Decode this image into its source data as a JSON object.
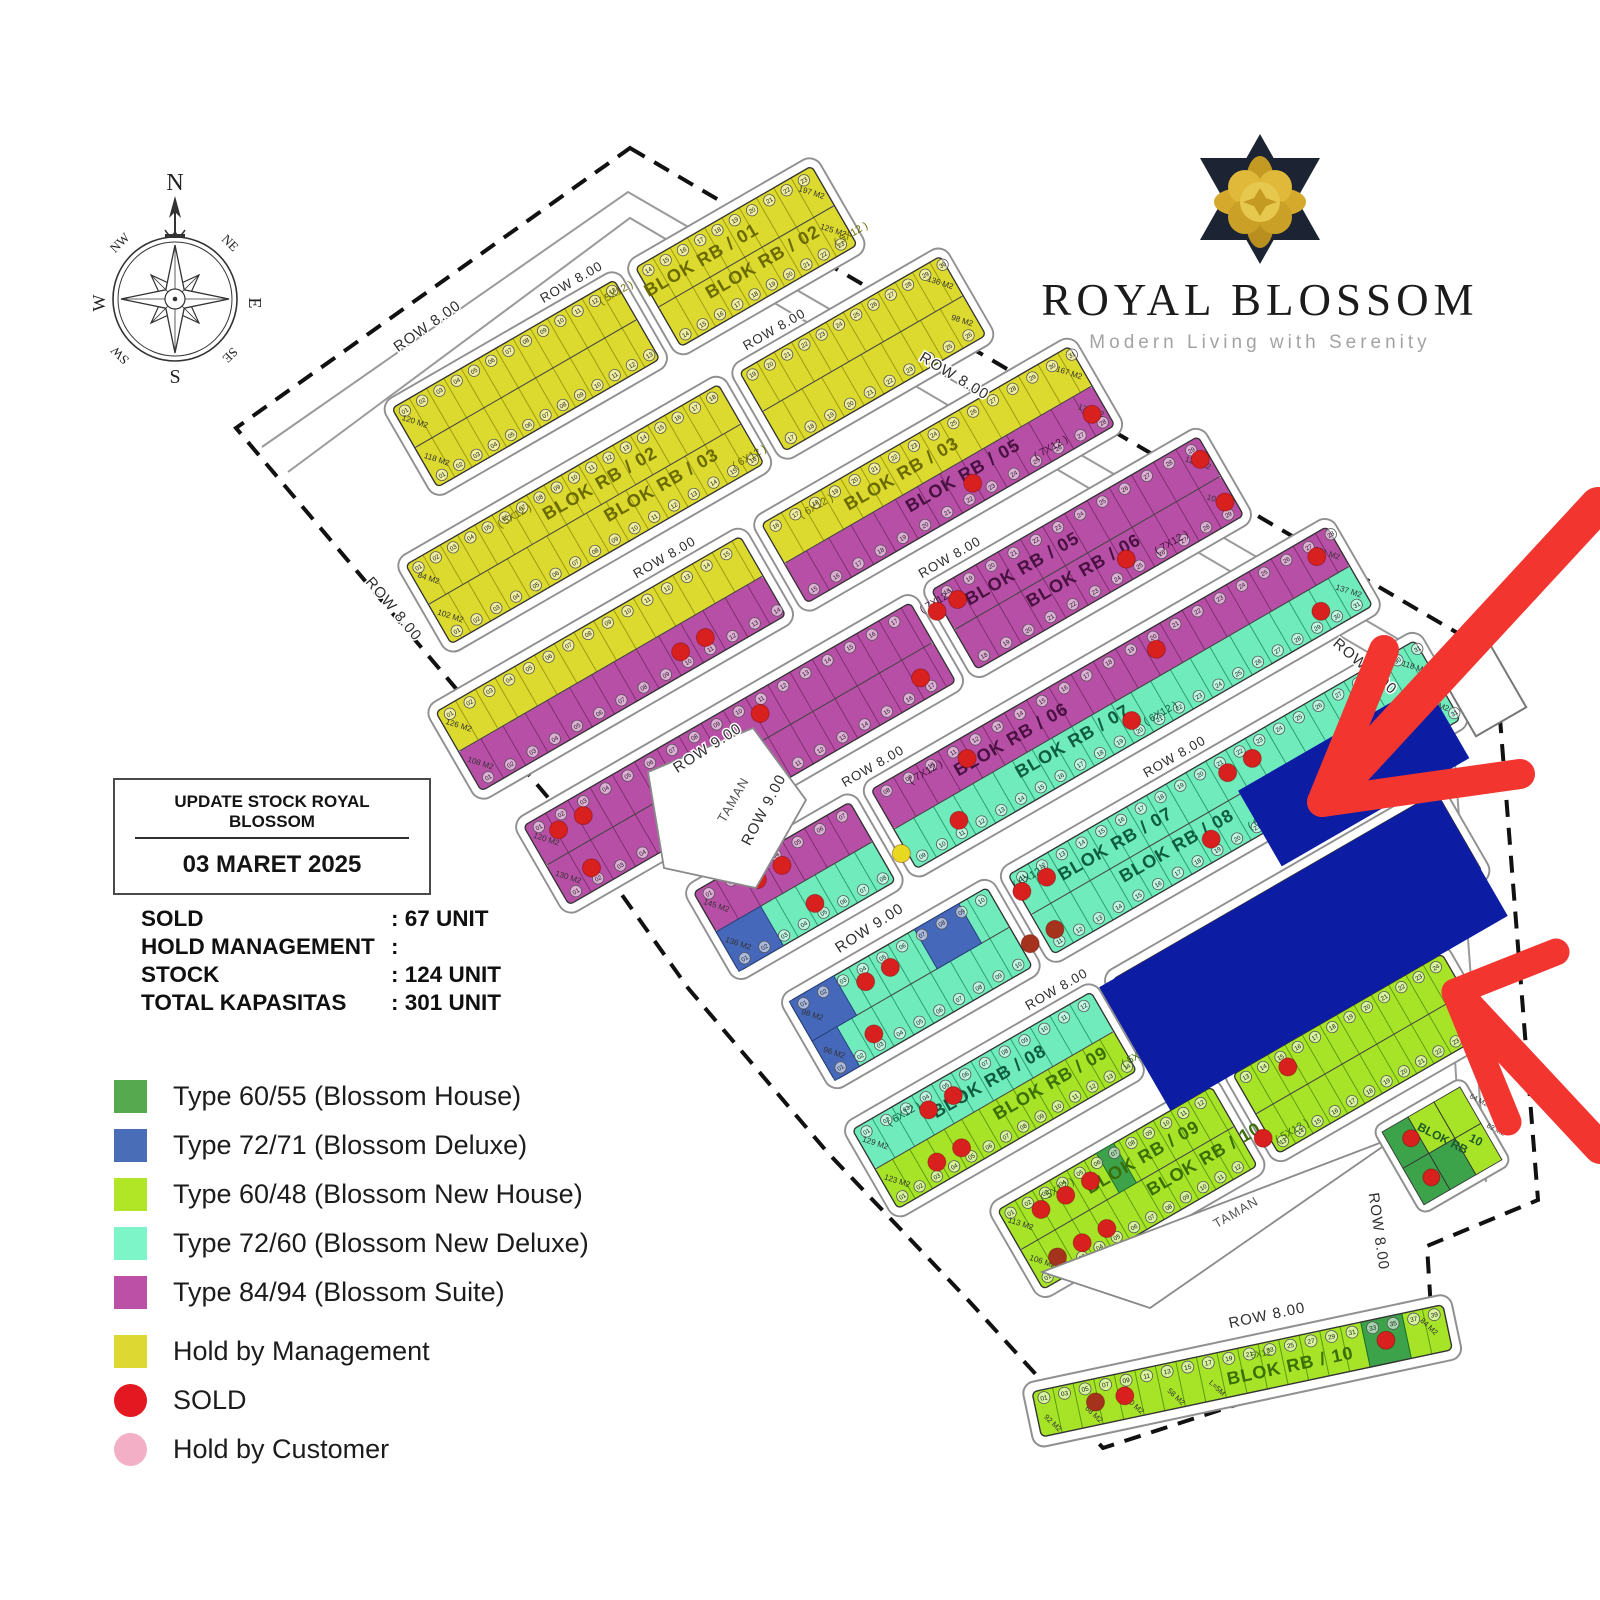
{
  "logo": {
    "title": "ROYAL BLOSSOM",
    "tagline": "Modern Living with Serenity",
    "flower_gold": "#d4a92c",
    "flower_dark": "#1c2433"
  },
  "compass": {
    "points": [
      "N",
      "NE",
      "E",
      "SE",
      "S",
      "SW",
      "W",
      "NW"
    ]
  },
  "stock_box": {
    "title": "UPDATE STOCK ROYAL BLOSSOM",
    "date": "03 MARET 2025"
  },
  "stats": [
    {
      "label": "SOLD",
      "value": ": 67 UNIT"
    },
    {
      "label": "HOLD MANAGEMENT",
      "value": ":"
    },
    {
      "label": "STOCK",
      "value": ": 124 UNIT"
    },
    {
      "label": "TOTAL KAPASITAS",
      "value": ": 301 UNIT"
    }
  ],
  "legend": [
    {
      "shape": "square",
      "color": "#56a94e",
      "label": "Type 60/55 (Blossom House)"
    },
    {
      "shape": "square",
      "color": "#4a6db8",
      "label": "Type 72/71 (Blossom Deluxe)"
    },
    {
      "shape": "square",
      "color": "#b0e626",
      "label": "Type 60/48 (Blossom New House)"
    },
    {
      "shape": "square",
      "color": "#7df5c9",
      "label": "Type 72/60 (Blossom New Deluxe)"
    },
    {
      "shape": "square",
      "color": "#bb50a6",
      "label": "Type 84/94 (Blossom Suite)"
    },
    {
      "shape": "square",
      "color": "#ddd832",
      "label": "Hold by Management",
      "gap": true
    },
    {
      "shape": "circle",
      "color": "#e31820",
      "label": "SOLD"
    },
    {
      "shape": "circle",
      "color": "#f2afc6",
      "label": "Hold by Customer"
    }
  ],
  "plan": {
    "angle": -30,
    "origin": [
      285,
      470
    ],
    "scale": 0.95,
    "pitch": 150,
    "strip_h": 96,
    "half_h": 48,
    "cross_gap": 26,
    "lot_w": {
      "5": 21,
      "6": 24,
      "7": 27
    },
    "road_label": "ROW 8.00",
    "colors": {
      "yellow": "#dcd92f",
      "purple": "#b84fa6",
      "teal": "#70ecbc",
      "lime": "#a7e428",
      "green": "#3da34b",
      "bluelot": "#4668bb",
      "navy": "#0c1da4",
      "sold": "#d8201f",
      "soldDark": "#a5321c",
      "hold": "#e8d820",
      "road": "#909090"
    },
    "label_fill": {
      "yellow": "#6a6a00",
      "purple": "#471140",
      "teal": "#0f5c40",
      "lime": "#3a6e06"
    },
    "line_fill": {
      "yellow": "#9a9a10",
      "purple": "#7c2e6e",
      "teal": "#2a9a72",
      "lime": "#5d9a12",
      "green": "#1d6e2a",
      "bluelot": "#24407e"
    },
    "boundary": [
      [
        630,
        148
      ],
      [
        1495,
        655
      ],
      [
        1538,
        1200
      ],
      [
        1427,
        1246
      ],
      [
        1433,
        1341
      ],
      [
        1103,
        1448
      ],
      [
        968,
        1300
      ],
      [
        828,
        1153
      ],
      [
        688,
        988
      ],
      [
        578,
        833
      ],
      [
        236,
        428
      ]
    ],
    "road_lines": [
      [
        [
          262,
          447
        ],
        [
          628,
          192
        ],
        [
          1448,
          668
        ],
        [
          1486,
          1182
        ]
      ],
      [
        [
          288,
          472
        ],
        [
          630,
          218
        ],
        [
          1432,
          690
        ],
        [
          1462,
          1172
        ]
      ]
    ],
    "rows": [
      {
        "u0": 130,
        "u1": 640,
        "splits": [
          400
        ],
        "label_u": 490,
        "road_u": 360,
        "top": {
          "name": "BLOK RB / 01",
          "dim": "5X12",
          "color": "yellow"
        },
        "bottom": {
          "name": "BLOK RB / 02",
          "dim": "5X12",
          "color": "yellow"
        },
        "left_labels": [
          "120 M2",
          "118 M2"
        ],
        "right_labels": [
          "197 M2",
          "125 M2"
        ],
        "dots": [],
        "special": []
      },
      {
        "u0": 60,
        "u1": 710,
        "splits": [
          440
        ],
        "label_u": 280,
        "road_u": 520,
        "top": {
          "name": "BLOK RB / 02",
          "dim": "5X12",
          "color": "yellow"
        },
        "bottom": {
          "name": "BLOK RB / 03",
          "dim": "6X12",
          "color": "yellow"
        },
        "left_labels": [
          "84 M2",
          "102 M2"
        ],
        "right_labels": [
          "136 M2",
          "98 M2"
        ],
        "dots": [],
        "special": []
      },
      {
        "u0": 10,
        "u1": 780,
        "splits": [
          380
        ],
        "label_u": 560,
        "road_u": 300,
        "top": {
          "name": "BLOK RB / 03",
          "dim": "6X12",
          "color": "yellow"
        },
        "bottom": {
          "name": "BLOK RB / 05",
          "dim": "7X12",
          "color": "purple"
        },
        "left_labels": [
          "126 M2",
          "108 M2"
        ],
        "right_labels": [
          "167 M2",
          "137 M2"
        ],
        "dots": [
          {
            "u": 265,
            "h": "b"
          },
          {
            "u": 295,
            "h": "b"
          },
          {
            "u": 620,
            "h": "b"
          },
          {
            "u": 765,
            "h": "b"
          }
        ],
        "special": []
      },
      {
        "u0": 30,
        "u1": 850,
        "splits": [
          500
        ],
        "label_u": 620,
        "road_u": 560,
        "top": {
          "name": "BLOK RB / 05",
          "dim": "7X12",
          "color": "purple"
        },
        "bottom": {
          "name": "BLOK RB / 06",
          "dim": "7X12",
          "color": "purple"
        },
        "left_labels": [
          "120 M2",
          "130 M2"
        ],
        "right_labels": [
          "128 M2",
          "102 M2"
        ],
        "dots": [
          {
            "u": 60,
            "h": "t"
          },
          {
            "u": 90,
            "h": "t"
          },
          {
            "u": 305,
            "h": "t"
          },
          {
            "u": 520,
            "h": "t"
          },
          {
            "u": 545,
            "h": "t"
          },
          {
            "u": 840,
            "h": "t"
          },
          {
            "u": 70,
            "h": "b"
          },
          {
            "u": 470,
            "h": "b"
          },
          {
            "u": 720,
            "h": "b"
          },
          {
            "u": 840,
            "h": "b"
          }
        ],
        "special": []
      },
      {
        "u0": 150,
        "u1": 920,
        "splits": [
          340
        ],
        "label_u": 520,
        "road_u": 380,
        "top": {
          "name": "BLOK RB / 06",
          "dim": "7X12",
          "color": "purple"
        },
        "bottom": {
          "name": "BLOK RB / 07",
          "dim": "6X12",
          "color": "teal"
        },
        "left_labels": [
          "145 M2",
          "136 M2"
        ],
        "right_labels": [
          "131 M2",
          "137 M2"
        ],
        "dots": [
          {
            "u": 215,
            "h": "t"
          },
          {
            "u": 245,
            "h": "t"
          },
          {
            "u": 470,
            "h": "t"
          },
          {
            "u": 700,
            "h": "t"
          },
          {
            "u": 895,
            "h": "t"
          },
          {
            "u": 255,
            "h": "b"
          },
          {
            "u": 430,
            "h": "b"
          },
          {
            "u": 640,
            "h": "b"
          },
          {
            "u": 870,
            "h": "b"
          },
          {
            "u": 360,
            "h": "b",
            "c": "hold"
          }
        ],
        "special": [
          {
            "u0": 150,
            "u1": 204,
            "h": "b",
            "c": "bluelot"
          }
        ]
      },
      {
        "u0": 180,
        "u1": 940,
        "splits": [
          420
        ],
        "label_u": 560,
        "road_u": 660,
        "top": {
          "name": "BLOK RB / 07",
          "dim": "6X12",
          "color": "teal"
        },
        "bottom": {
          "name": "BLOK RB / 08",
          "dim": "6X12",
          "color": "teal"
        },
        "left_labels": [
          "98 M2",
          "96 M2"
        ],
        "right_labels": [
          "118 M2",
          "116 M2"
        ],
        "dots": [
          {
            "u": 260,
            "h": "t"
          },
          {
            "u": 290,
            "h": "t"
          },
          {
            "u": 450,
            "h": "t"
          },
          {
            "u": 480,
            "h": "t"
          },
          {
            "u": 700,
            "h": "t"
          },
          {
            "u": 730,
            "h": "t"
          },
          {
            "u": 240,
            "h": "b"
          },
          {
            "u": 430,
            "h": "b",
            "c": "soldDark"
          },
          {
            "u": 460,
            "h": "b",
            "c": "soldDark"
          },
          {
            "u": 650,
            "h": "b"
          },
          {
            "u": 900,
            "h": "b"
          }
        ],
        "special": [
          {
            "u0": 180,
            "u1": 234,
            "h": "t",
            "c": "bluelot"
          },
          {
            "u0": 180,
            "u1": 210,
            "h": "b",
            "c": "bluelot"
          },
          {
            "u0": 332,
            "u1": 386,
            "h": "t",
            "c": "bluelot"
          }
        ]
      },
      {
        "u0": 170,
        "u1": 880,
        "splits": [
          460
        ],
        "label_u": 320,
        "road_u": 430,
        "top": {
          "name": "BLOK RB / 08",
          "dim": "6X12",
          "color": "teal"
        },
        "bottom": {
          "name": "BLOK RB / 09",
          "dim": "5X12",
          "color": "lime"
        },
        "left_labels": [
          "129 M2",
          "123 M2"
        ],
        "right_labels": [
          "118 M2",
          ""
        ],
        "dots": [
          {
            "u": 250,
            "h": "t"
          },
          {
            "u": 280,
            "h": "t"
          },
          {
            "u": 540,
            "h": "t"
          },
          {
            "u": 570,
            "h": "t"
          },
          {
            "u": 230,
            "h": "b"
          },
          {
            "u": 260,
            "h": "b"
          },
          {
            "u": 520,
            "h": "b"
          }
        ],
        "special": []
      },
      {
        "u0": 260,
        "u1": 800,
        "splits": [
          520
        ],
        "label_u": 420,
        "road_u": 620,
        "top": {
          "name": "BLOK RB / 09",
          "dim": "5X12",
          "color": "lime"
        },
        "bottom": {
          "name": "BLOK RB / 10",
          "dim": "5X12",
          "color": "lime"
        },
        "left_labels": [
          "113 M2",
          "106 M2"
        ],
        "right_labels": [
          "",
          ""
        ],
        "dots": [
          {
            "u": 300,
            "h": "t"
          },
          {
            "u": 330,
            "h": "t"
          },
          {
            "u": 360,
            "h": "t"
          },
          {
            "u": 600,
            "h": "t"
          },
          {
            "u": 290,
            "h": "b",
            "c": "soldDark"
          },
          {
            "u": 320,
            "h": "b"
          },
          {
            "u": 350,
            "h": "b"
          },
          {
            "u": 540,
            "h": "b"
          }
        ],
        "special": [
          {
            "u0": 380,
            "u1": 401,
            "h": "t",
            "c": "green"
          }
        ]
      }
    ],
    "below_label": {
      "u": 430,
      "v": 1190
    },
    "overlays": [
      {
        "u": 700,
        "v": 794,
        "w": 228,
        "h": 92
      },
      {
        "u": 470,
        "v": 900,
        "w": 410,
        "h": 150
      }
    ],
    "taman": {
      "label": "TAMAN",
      "pentagon": [
        [
          648,
          772
        ],
        [
          753,
          728
        ],
        [
          806,
          800
        ],
        [
          756,
          888
        ],
        [
          664,
          868
        ]
      ],
      "pentagon_label": [
        737,
        802,
        -60
      ],
      "triangle": [
        [
          1042,
          1272
        ],
        [
          1398,
          1136
        ],
        [
          1150,
          1308
        ]
      ],
      "triangle_label": [
        1238,
        1216,
        -30
      ]
    },
    "gate": {
      "x": 1432,
      "y": 660,
      "w": 58,
      "h": 88,
      "r": -30
    },
    "screen_labels": [
      {
        "t": "ROW 8.00",
        "x": 430,
        "y": 330,
        "r": -35
      },
      {
        "t": "ROW 8.00",
        "x": 390,
        "y": 612,
        "r": 50
      },
      {
        "t": "ROW 8.00",
        "x": 952,
        "y": 380,
        "r": 31
      },
      {
        "t": "ROW 8.00",
        "x": 1362,
        "y": 670,
        "r": 40
      },
      {
        "t": "ROW 9.00",
        "x": 710,
        "y": 752,
        "r": -33
      },
      {
        "t": "ROW 9.00",
        "x": 768,
        "y": 812,
        "r": -62
      },
      {
        "t": "ROW 9.00",
        "x": 872,
        "y": 932,
        "r": -33
      },
      {
        "t": "ROW 8.00",
        "x": 1374,
        "y": 1232,
        "r": 82
      },
      {
        "t": "ROW 8.00",
        "x": 1268,
        "y": 1320,
        "r": -12
      }
    ],
    "bottom_strip": {
      "x": 1032,
      "y": 1392,
      "r": -12,
      "len": 420,
      "h": 46,
      "lot_w": 21,
      "name": "BLOK RB / 10",
      "dim": "5X12",
      "color": "lime",
      "area_labels": [
        "92 M2",
        "68 M2",
        "70 M2",
        "58 M2",
        "L=5M"
      ],
      "right_label": "84 M2",
      "green_lot": [
        336,
        378
      ],
      "dots": [
        60,
        90,
        357
      ]
    },
    "corner": {
      "x": 1382,
      "y": 1132,
      "r": -30,
      "cw": 30,
      "ch": 42,
      "cells": [
        "green",
        "lime",
        "lime",
        "green",
        "green",
        "lime"
      ],
      "label1": "BLOK RB",
      "label2": "10",
      "side_labels": [
        "64 M2",
        "62 M2"
      ],
      "dots": [
        [
          22,
          20
        ],
        [
          20,
          64
        ]
      ]
    }
  },
  "arrows": {
    "color": "#f2352f",
    "items": [
      {
        "shaft": [
          [
            1598,
            505
          ],
          [
            1330,
            795
          ]
        ],
        "arm1": [
          [
            1322,
            802
          ],
          [
            1384,
            650
          ]
        ],
        "arm2": [
          [
            1322,
            802
          ],
          [
            1520,
            774
          ]
        ],
        "w": 36,
        "aw": 30
      },
      {
        "shaft": [
          [
            1600,
            1148
          ],
          [
            1462,
            1000
          ]
        ],
        "arm1": [
          [
            1455,
            992
          ],
          [
            1556,
            952
          ]
        ],
        "arm2": [
          [
            1455,
            992
          ],
          [
            1508,
            1122
          ]
        ],
        "w": 32,
        "aw": 27
      }
    ]
  }
}
